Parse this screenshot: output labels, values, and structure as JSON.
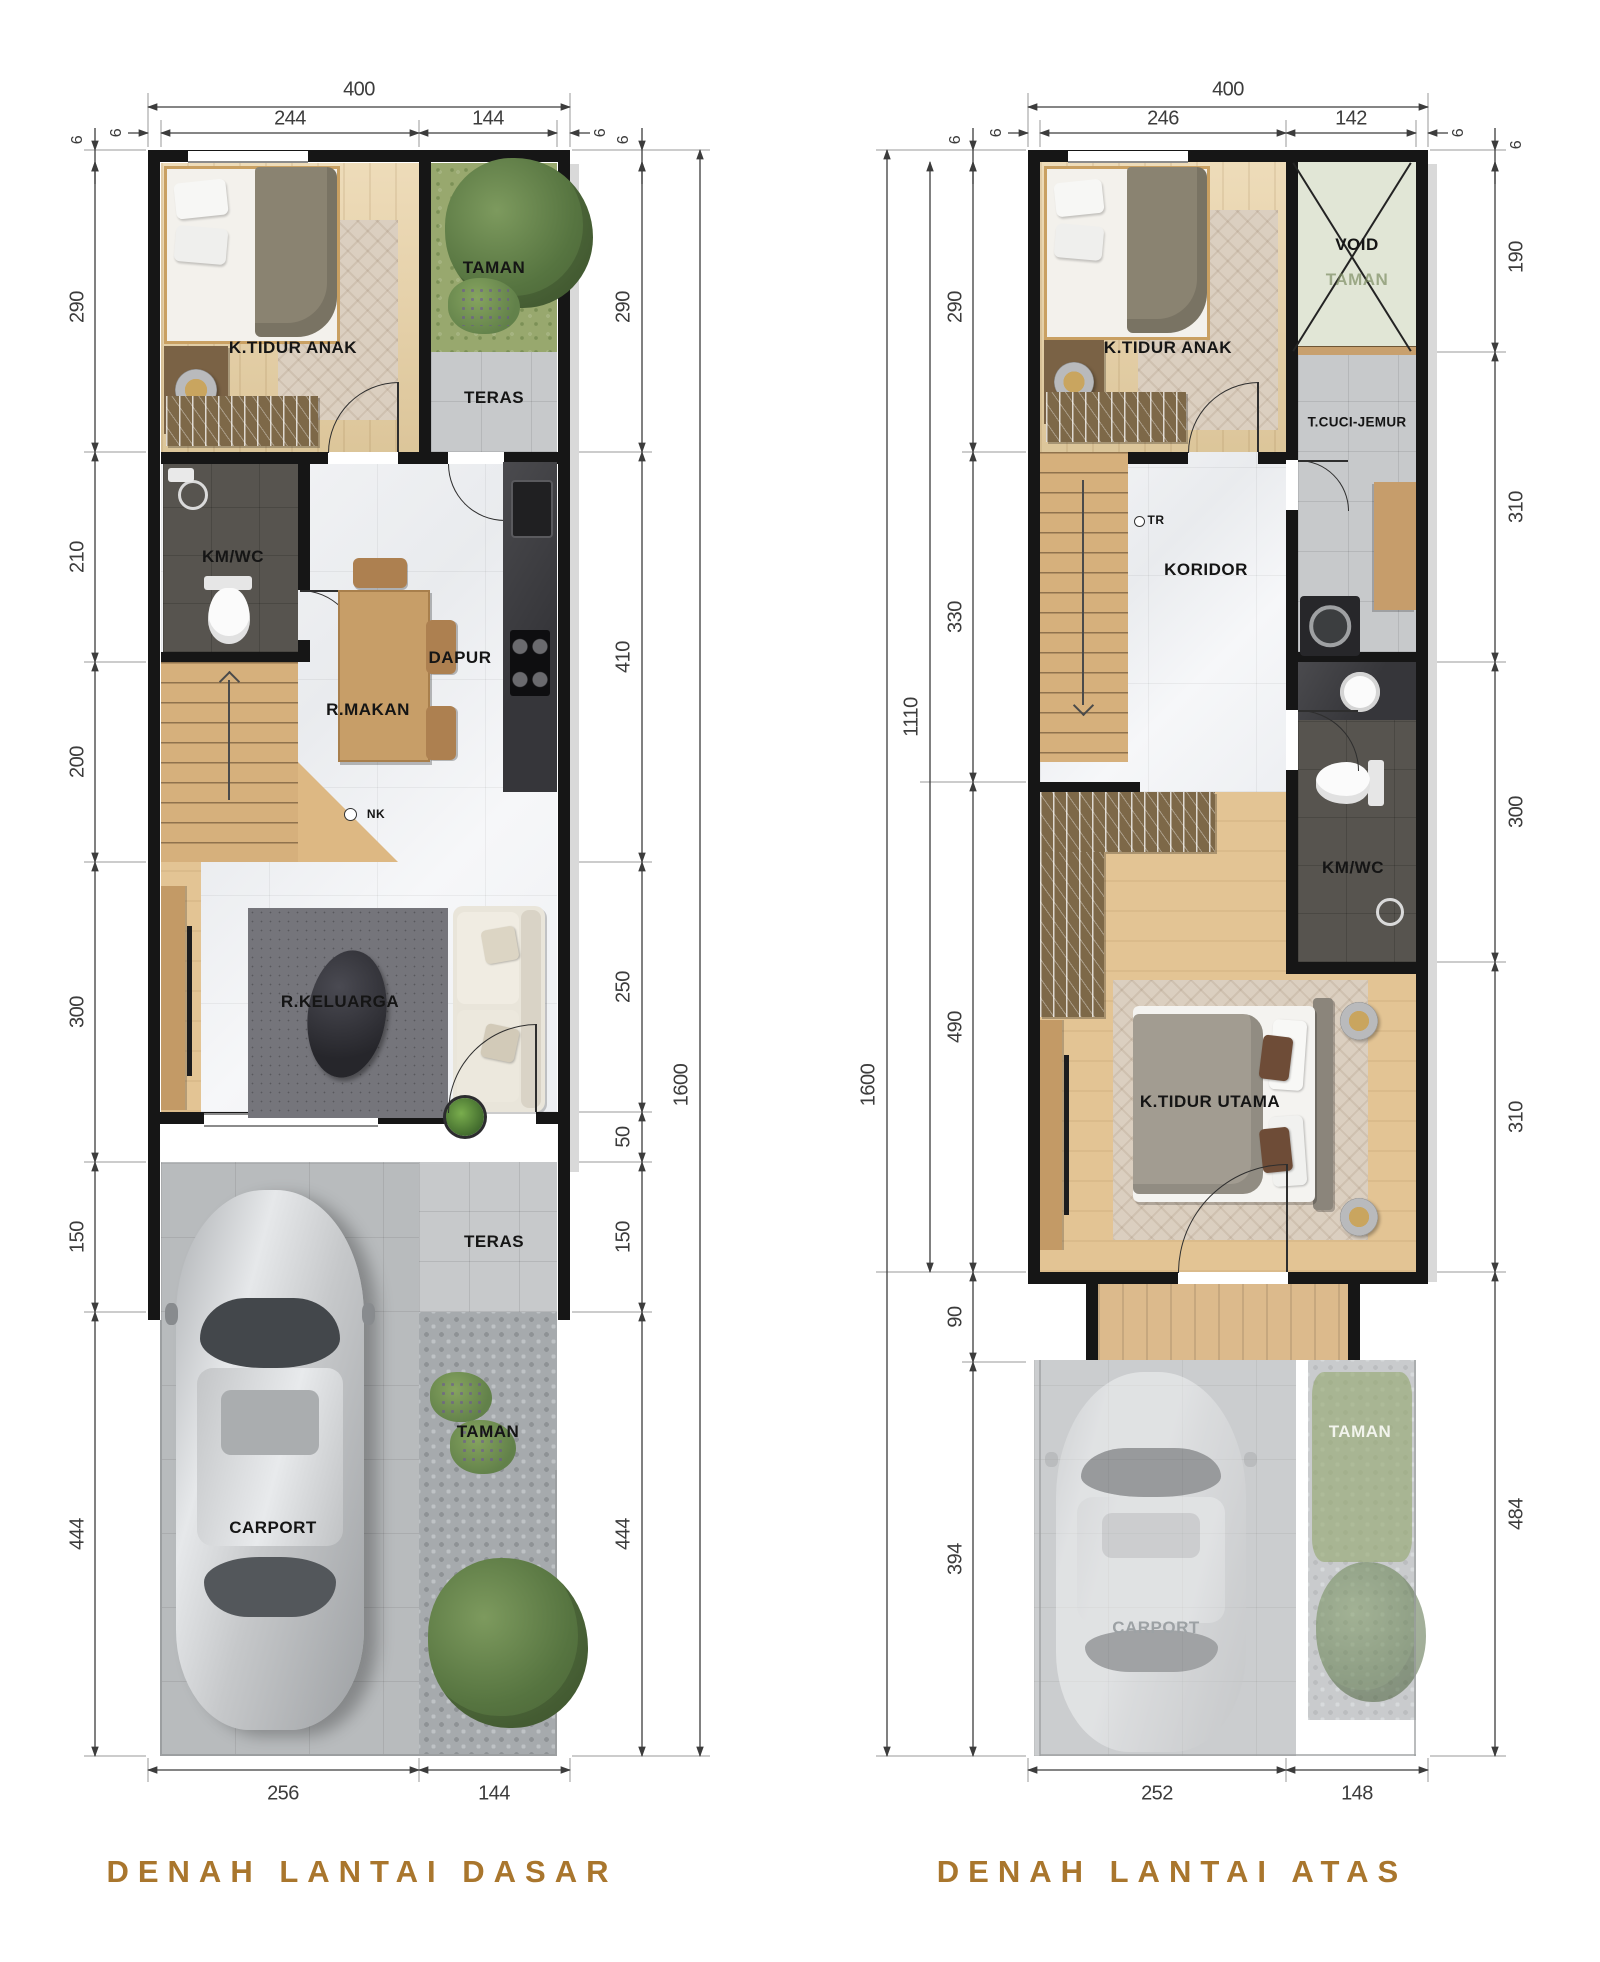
{
  "ground_floor": {
    "title": "DENAH LANTAI DASAR",
    "rooms": {
      "bedroom": "K.TIDUR ANAK",
      "garden_top": "TAMAN",
      "terrace_top": "TERAS",
      "bathroom": "KM/WC",
      "dining": "R.MAKAN",
      "kitchen": "DAPUR",
      "living": "R.KELUARGA",
      "terrace_front": "TERAS",
      "garden_front": "TAMAN",
      "carport": "CARPORT"
    },
    "labels": {
      "nk": "NK"
    },
    "dims": {
      "top_total": "400",
      "top_left": "244",
      "top_right": "144",
      "top_wall_left": "6",
      "top_wall_right": "6",
      "left_wall": "6",
      "left_1": "290",
      "left_2": "210",
      "left_3": "200",
      "left_4": "300",
      "left_5": "150",
      "left_6": "444",
      "right_wall": "6",
      "right_1": "290",
      "right_2": "410",
      "right_3": "250",
      "right_4": "50",
      "right_5": "150",
      "right_6": "444",
      "total_height": "1600",
      "bottom_left": "256",
      "bottom_right": "144"
    }
  },
  "upper_floor": {
    "title": "DENAH LANTAI ATAS",
    "rooms": {
      "bedroom": "K.TIDUR ANAK",
      "void": "VOID",
      "void_sub": "TAMAN",
      "laundry": "T.CUCI-JEMUR",
      "corridor": "KORIDOR",
      "bathroom": "KM/WC",
      "master": "K.TIDUR UTAMA",
      "carport": "CARPORT",
      "garden": "TAMAN"
    },
    "labels": {
      "tr": "TR"
    },
    "dims": {
      "top_total": "400",
      "top_left": "246",
      "top_right": "142",
      "top_wall_left": "6",
      "top_wall_right": "6",
      "left_wall": "6",
      "left_1": "290",
      "left_2": "330",
      "left_3": "490",
      "left_4": "90",
      "left_5": "394",
      "left_mid": "1110",
      "total_height": "1600",
      "right_wall": "6",
      "right_1": "190",
      "right_2": "310",
      "right_3": "300",
      "right_4": "310",
      "right_5": "484",
      "bottom_left": "252",
      "bottom_right": "148"
    }
  }
}
